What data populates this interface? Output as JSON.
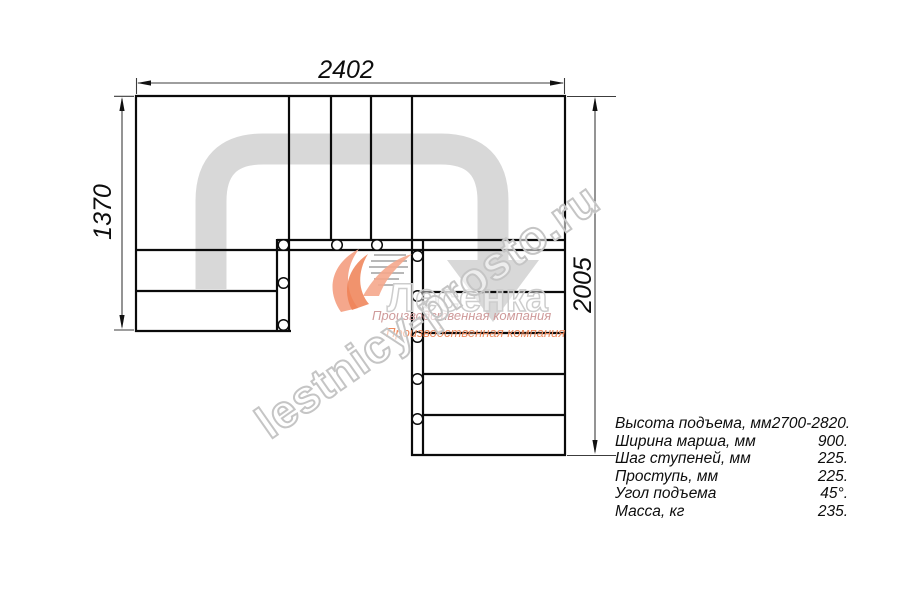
{
  "dimensions": {
    "width_top": "2402",
    "height_left": "1370",
    "height_right": "2005"
  },
  "specs": {
    "rows": [
      {
        "label": "Высота подъема, мм",
        "value": "2700-2820."
      },
      {
        "label": "Ширина марша, мм",
        "value": "900."
      },
      {
        "label": "Шаг ступеней, мм",
        "value": "225."
      },
      {
        "label": "Проступь, мм",
        "value": "225."
      },
      {
        "label": "Угол подъема",
        "value": "45°."
      },
      {
        "label": "Масса, кг",
        "value": "235."
      }
    ]
  },
  "watermark": {
    "site": "lestnicy-prosto.ru",
    "logo_text": "Лесенка",
    "company_line1": "Производственная компания",
    "company_line2": "Производственная компания"
  },
  "colors": {
    "line": "#0a0a0a",
    "dim": "#3c3c3c",
    "path-grey": "#d8d8d8",
    "wm-grey": "#c5c5c5",
    "logo-orange": "#ef8054",
    "logo-orange-light": "#f5a78c",
    "company-pink": "#cf9b9b",
    "company-orange": "#ee8a5e",
    "bg": "#ffffff"
  }
}
